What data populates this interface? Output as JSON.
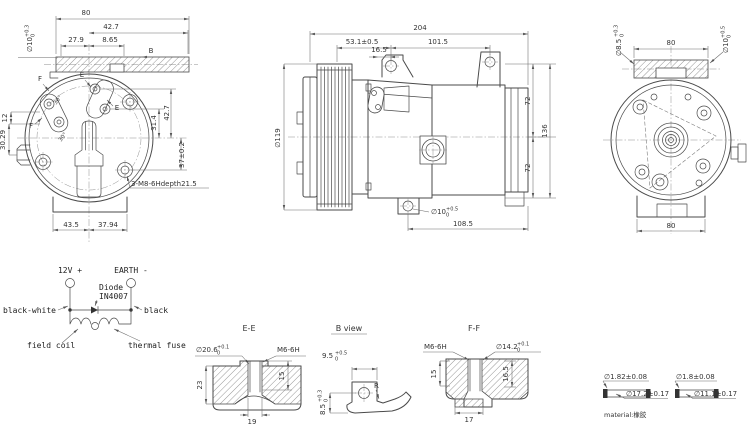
{
  "colors": {
    "line": "#4a4a4a",
    "dim_text": "#333333",
    "background": "#ffffff"
  },
  "front_view": {
    "dim_80": "80",
    "dim_42_7_top": "42.7",
    "dim_27_9": "27.9",
    "dim_8_65": "8.65",
    "dia_10": {
      "base": "∅10",
      "plus": "+0.3",
      "minus": "0"
    },
    "view_arrow_b": "B",
    "dim_31_4": "31.4",
    "dim_42_7_right": "42.7",
    "dim_37": "37±0.2",
    "dim_12": "12",
    "dim_30_29": "30.29",
    "thread_note": "3-M8-6Hdepth21.5",
    "dim_43_5": "43.5",
    "dim_37_94": "37.94",
    "angle_30": "30°",
    "section_e": "E",
    "section_f": "F"
  },
  "side_view": {
    "dim_204": "204",
    "dim_53_1": "53.1±0.5",
    "dim_101_5": "101.5",
    "dim_16_5": "16.5",
    "dia_119": "∅119",
    "dim_72_upper": "72",
    "dim_72_lower": "72",
    "dim_136": "136",
    "dia_10": {
      "base": "∅10",
      "plus": "+0.5",
      "minus": "0"
    },
    "dim_108_5": "108.5"
  },
  "rear_view": {
    "dia_8_5": {
      "base": "∅8.5",
      "plus": "+0.3",
      "minus": "0"
    },
    "dim_80_top": "80",
    "dia_10": {
      "base": "∅10",
      "plus": "+0.5",
      "minus": "0"
    },
    "dim_80_bottom": "80"
  },
  "wiring": {
    "terminal_positive": "12V +",
    "terminal_earth": "EARTH -",
    "diode_label_line1": "Diode",
    "diode_label_line2": "IN4007",
    "wire_black_white": "black-white",
    "wire_black": "black",
    "field_coil": "field coil",
    "thermal_fuse": "thermal fuse"
  },
  "section_ee": {
    "title": "E-E",
    "dia_20_6": {
      "base": "∅20.6",
      "plus": "+0.1",
      "minus": "0"
    },
    "thread": "M6-6H",
    "dim_23": "23",
    "dim_15": "15",
    "dim_19": "19"
  },
  "view_b": {
    "title": "B view",
    "dim_9_5": {
      "base": "9.5",
      "plus": "+0.5",
      "minus": "0"
    },
    "radius_label": "R",
    "dim_8_5": {
      "base": "8.5",
      "plus": "+0.3",
      "minus": "0"
    }
  },
  "section_ff": {
    "title": "F-F",
    "thread": "M6-6H",
    "dia_14_2": {
      "base": "∅14.2",
      "plus": "+0.1",
      "minus": "0"
    },
    "dim_15": "15",
    "dim_16_5": "16.5",
    "dim_17": "17"
  },
  "oring_specs": {
    "left": {
      "cross_section": "∅1.82±0.08",
      "diameter": "∅17.2±0.17"
    },
    "right": {
      "cross_section": "∅1.8±0.08",
      "diameter": "∅11.1±0.17"
    },
    "material": "material:橡胶"
  }
}
